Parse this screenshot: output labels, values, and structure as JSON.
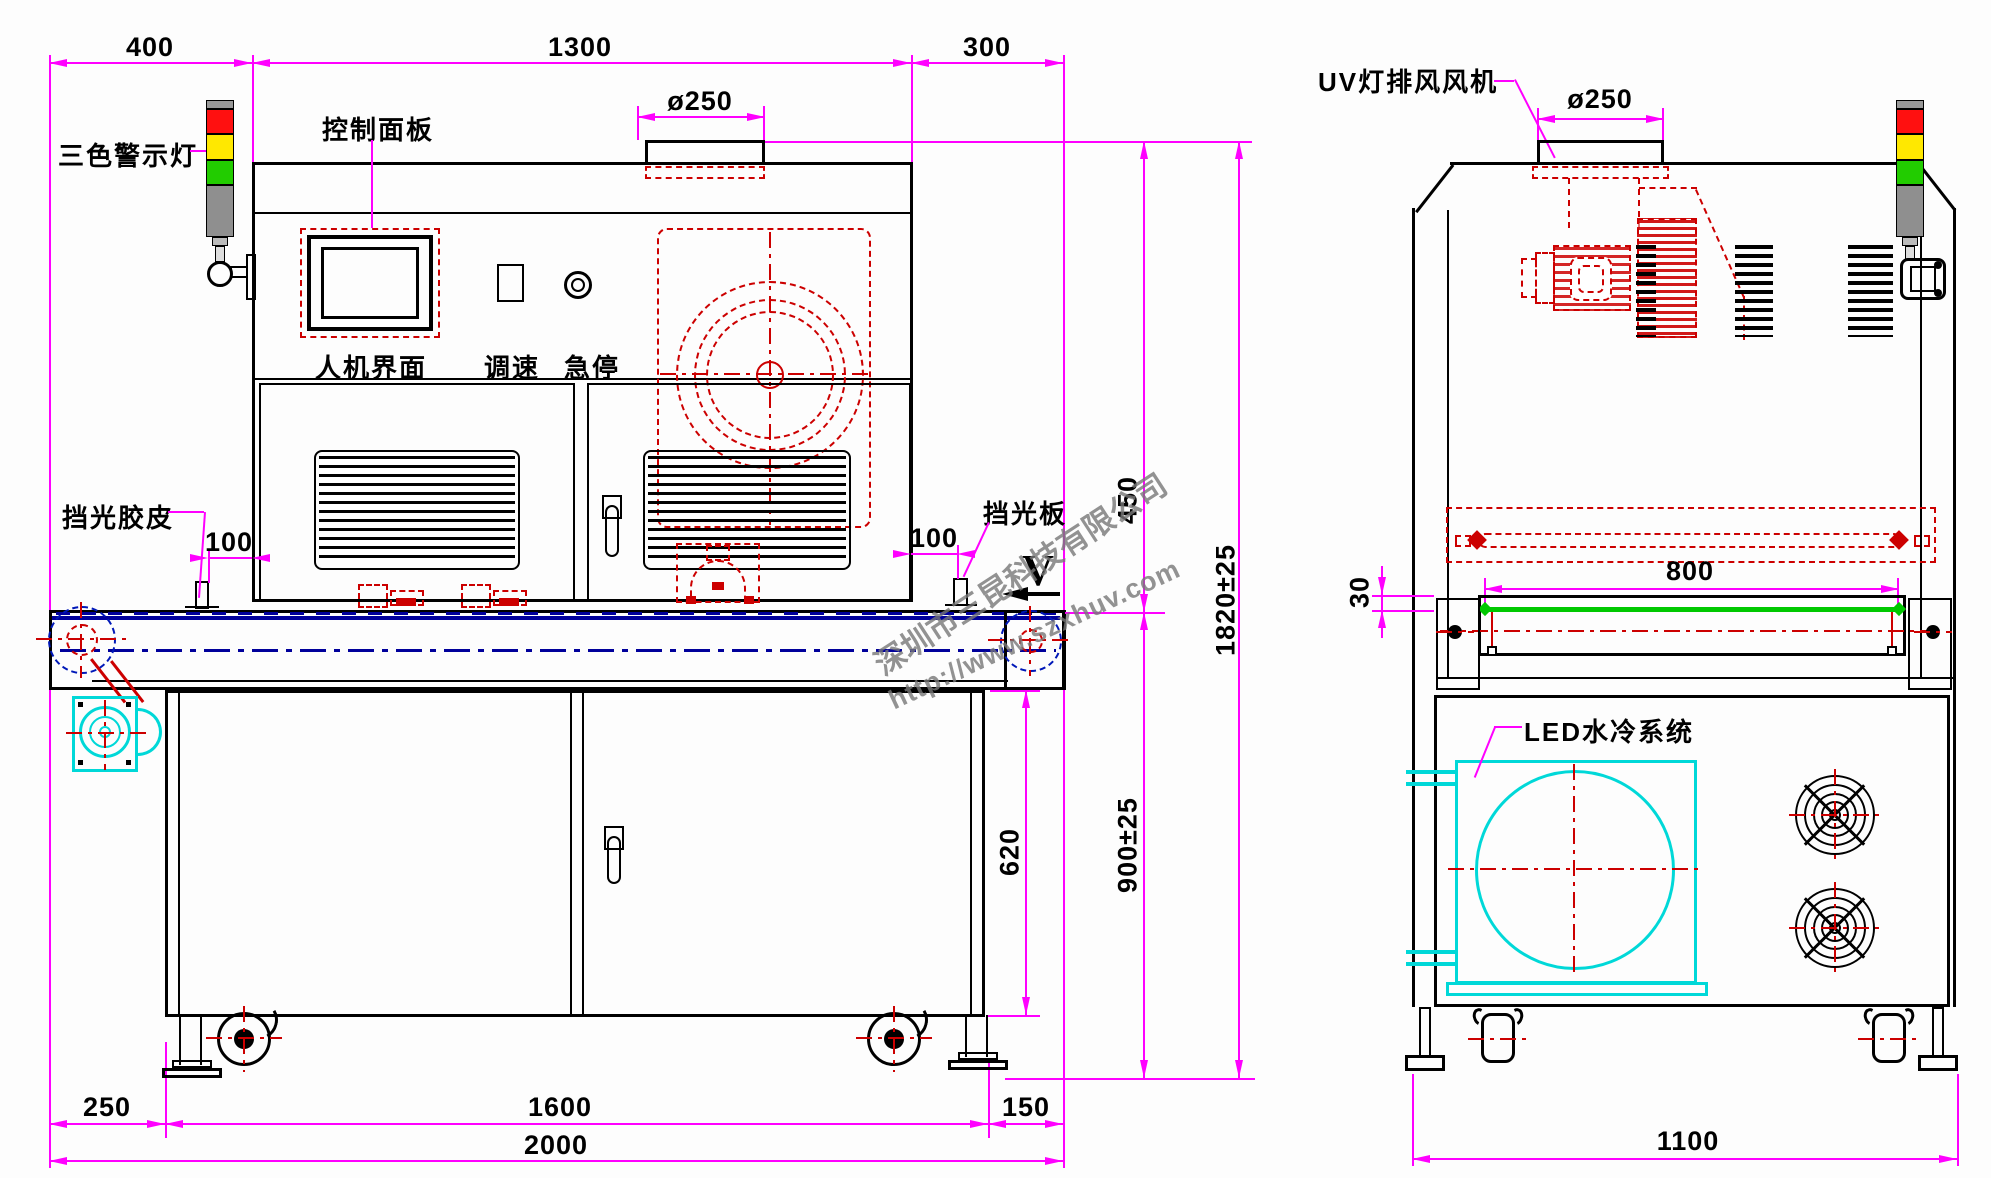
{
  "watermark": {
    "company": "深圳市三昆科技有限公司",
    "url": "http://www.szxhuv.com"
  },
  "colors": {
    "dimension_magenta": "#FF00FF",
    "detail_red": "#CC0000",
    "belt_navy": "#00009B",
    "accent_cyan": "#00D8D8",
    "belt_green": "#00C800",
    "tower_red": "#FF1010",
    "tower_yellow": "#FFE800",
    "tower_green": "#22CC00",
    "tower_gray": "#8F8F8F"
  },
  "front_view": {
    "labels": {
      "tower_light": "三色警示灯",
      "control_panel": "控制面板",
      "hmi": "人机界面",
      "speed_control": "调速",
      "emergency_stop": "急停",
      "light_shield_rubber": "挡光胶皮",
      "light_shield_plate": "挡光板",
      "belt_direction": "V"
    },
    "dims": {
      "left_overhang": "400",
      "body_width": "1300",
      "right_overhang": "300",
      "duct_diameter": "ø250",
      "rubber_offset": "100",
      "plate_offset": "100",
      "upper_height": "450",
      "total_height": "1820±25",
      "belt_height": "900±25",
      "cabinet_height": "620",
      "left_margin": "250",
      "base_width": "1600",
      "right_margin": "150",
      "total_width": "2000"
    }
  },
  "side_view": {
    "labels": {
      "exhaust_fan": "UV灯排风风机",
      "water_cooling": "LED水冷系统"
    },
    "dims": {
      "duct_diameter": "ø250",
      "lamp_width": "800",
      "belt_clearance": "30",
      "total_depth": "1100"
    }
  }
}
